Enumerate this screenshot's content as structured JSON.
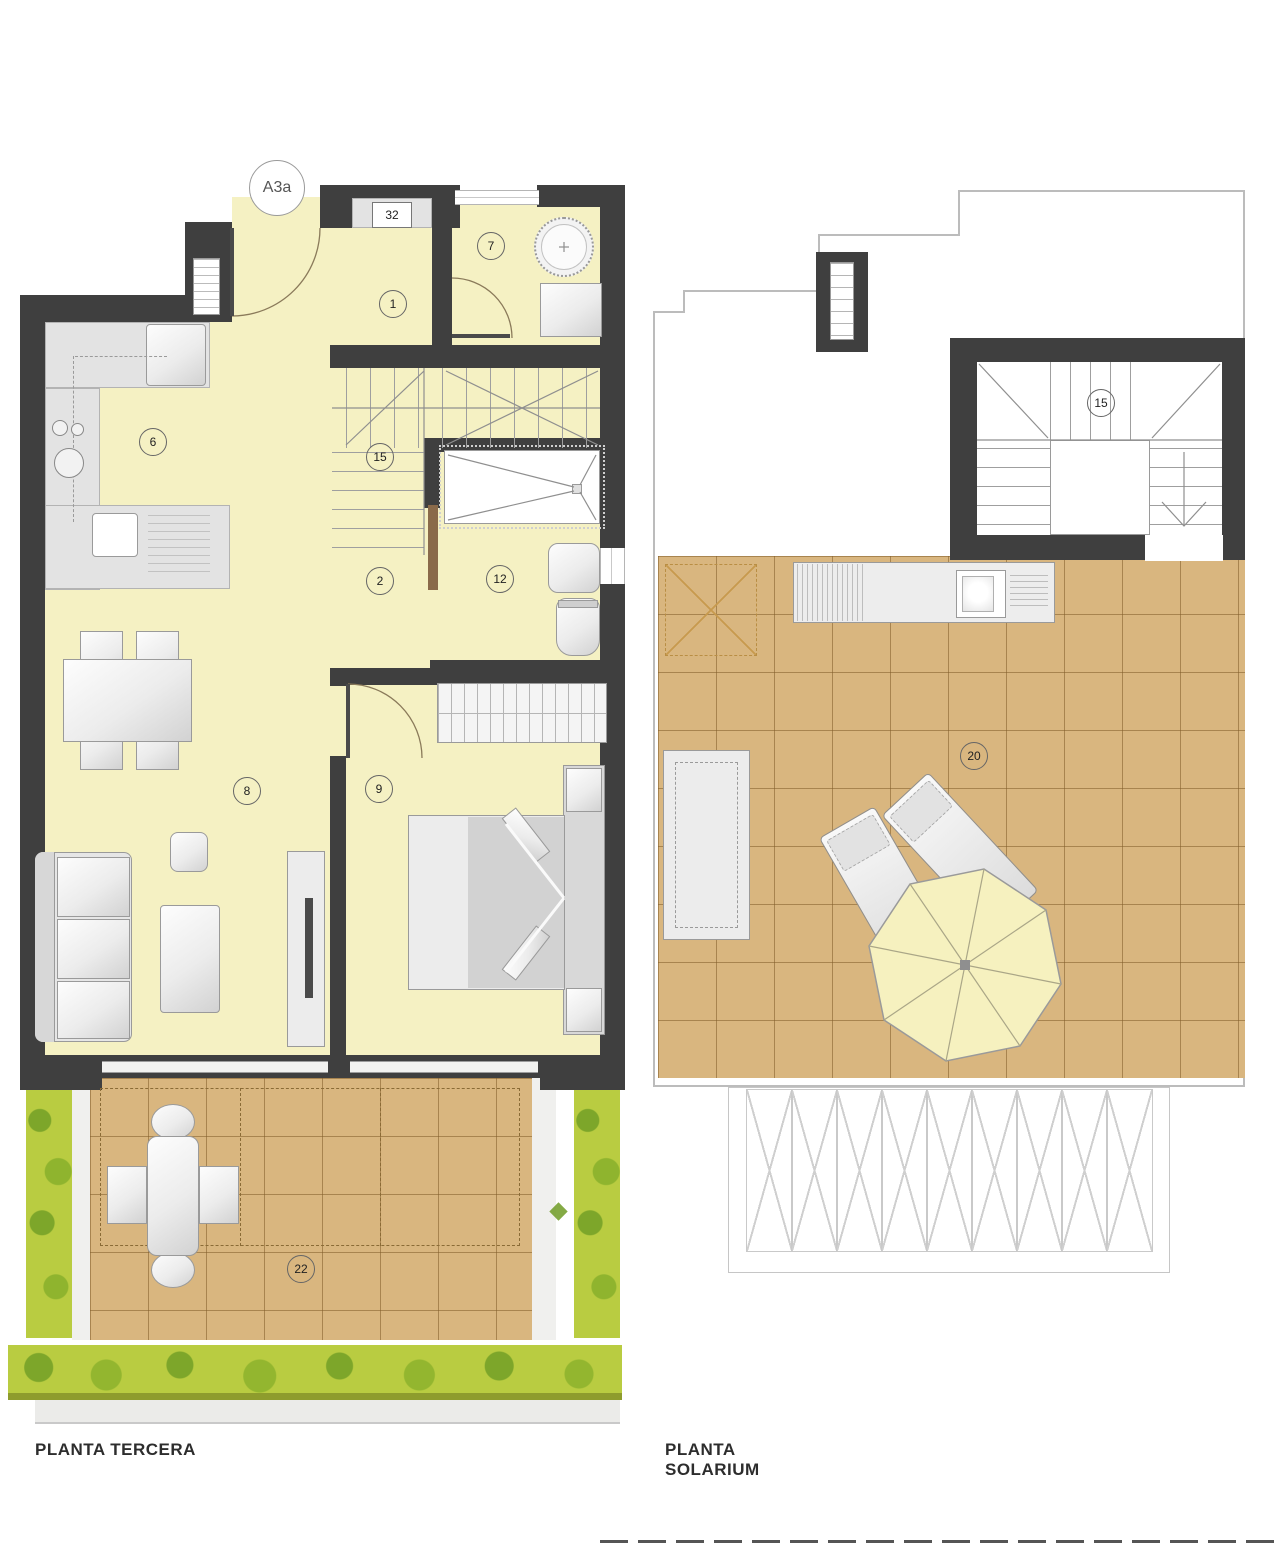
{
  "unit_badge": "A3a",
  "plans": {
    "tercera": {
      "title": "PLANTA TERCERA",
      "labels": {
        "closet": "32",
        "bathroom_top": "7",
        "hallway": "1",
        "kitchen": "6",
        "stairs": "15",
        "distributor": "2",
        "bathroom_main": "12",
        "living_room": "8",
        "bedroom": "9",
        "terrace": "22"
      }
    },
    "solarium": {
      "title": "PLANTA SOLARIUM",
      "labels": {
        "stairwell": "15",
        "roof_terrace": "20"
      }
    }
  },
  "colors": {
    "wall": "#3f3f3f",
    "interior_floor": "#f5f1c3",
    "tile_floor": "#d9b67f",
    "greenery": "#b9cc41",
    "greenery_dark": "#7da62a",
    "furniture_stroke": "#9a9a9a",
    "door_wood": "#8a6a4a"
  }
}
